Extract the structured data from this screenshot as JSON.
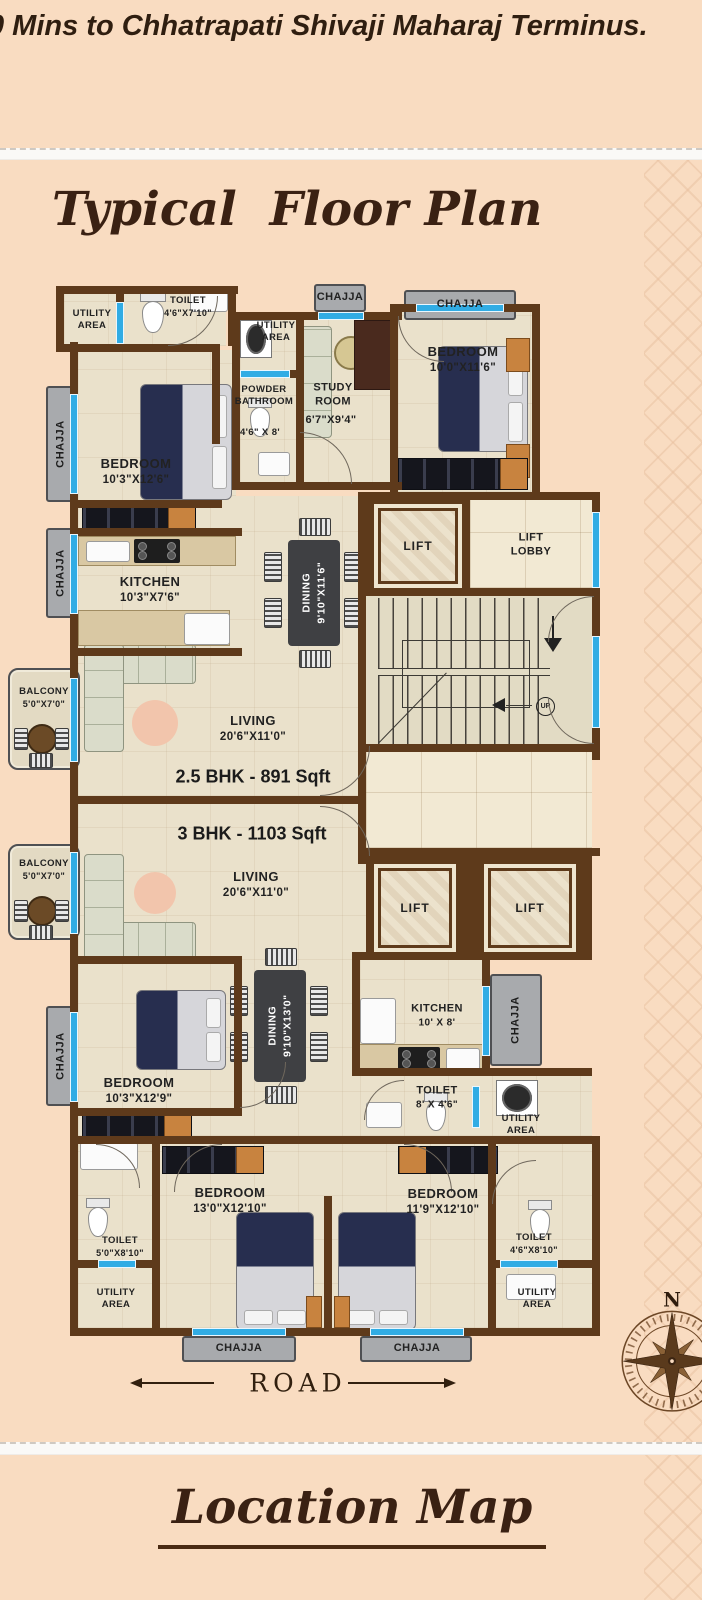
{
  "header": {
    "headline": "0 Mins to Chhatrapati Shivaji Maharaj Terminus."
  },
  "sections": {
    "floor_plan_title": "Typical  Floor Plan",
    "location_map_title": "Location Map"
  },
  "plan": {
    "labels": {
      "chajja": "CHAJJA",
      "lift": "LIFT",
      "lift_lobby": "LIFT LOBBY",
      "up": "UP",
      "road": "ROAD",
      "north": "N",
      "bhk25": "2.5 BHK - 891 Sqft",
      "bhk3": "3 BHK - 1103 Sqft"
    },
    "rooms": {
      "utility_tl": {
        "name": "UTILITY AREA"
      },
      "toilet_tl": {
        "name": "TOILET",
        "size": "4'6\"X7'10\""
      },
      "bedroom_tl": {
        "name": "BEDROOM",
        "size": "10'3\"X12'6\""
      },
      "utility_top2": {
        "name": "UTILITY AREA"
      },
      "powder": {
        "name": "POWDER BATHROOM",
        "size": "4'6\" X 8'"
      },
      "study": {
        "name": "STUDY ROOM",
        "size": "6'7\"X9'4\""
      },
      "bedroom_tr": {
        "name": "BEDROOM",
        "size": "10'0\"X11'6\""
      },
      "kitchen_25": {
        "name": "KITCHEN",
        "size": "10'3\"X7'6\""
      },
      "dining_25": {
        "name": "DINING",
        "size": "9'10\"X11'6\""
      },
      "living_25": {
        "name": "LIVING",
        "size": "20'6\"X11'0\""
      },
      "balcony_1": {
        "name": "BALCONY",
        "size": "5'0\"X7'0\""
      },
      "balcony_2": {
        "name": "BALCONY",
        "size": "5'0\"X7'0\""
      },
      "living_3": {
        "name": "LIVING",
        "size": "20'6\"X11'0\""
      },
      "bedroom_3l": {
        "name": "BEDROOM",
        "size": "10'3\"X12'9\""
      },
      "dining_3": {
        "name": "DINING",
        "size": "9'10\"X13'0\""
      },
      "kitchen_3": {
        "name": "KITCHEN",
        "size": "10' X 8'"
      },
      "toilet_3m": {
        "name": "TOILET",
        "size": "8' X 4'6\""
      },
      "utility_3m": {
        "name": "UTILITY AREA"
      },
      "toilet_bl": {
        "name": "TOILET",
        "size": "5'0\"X8'10\""
      },
      "utility_bl": {
        "name": "UTILITY AREA"
      },
      "bedroom_b1": {
        "name": "BEDROOM",
        "size": "13'0\"X12'10\""
      },
      "bedroom_b2": {
        "name": "BEDROOM",
        "size": "11'9\"X12'10\""
      },
      "toilet_br": {
        "name": "TOILET",
        "size": "4'6\"X8'10\""
      },
      "utility_br": {
        "name": "UTILITY AREA"
      }
    },
    "colors": {
      "wall": "#5e3a1b",
      "floor": "#eae1cb",
      "window": "#31ace4",
      "chajja": "#a8aaad",
      "accent": "#3a2113",
      "background": "#f9dcc1"
    }
  }
}
